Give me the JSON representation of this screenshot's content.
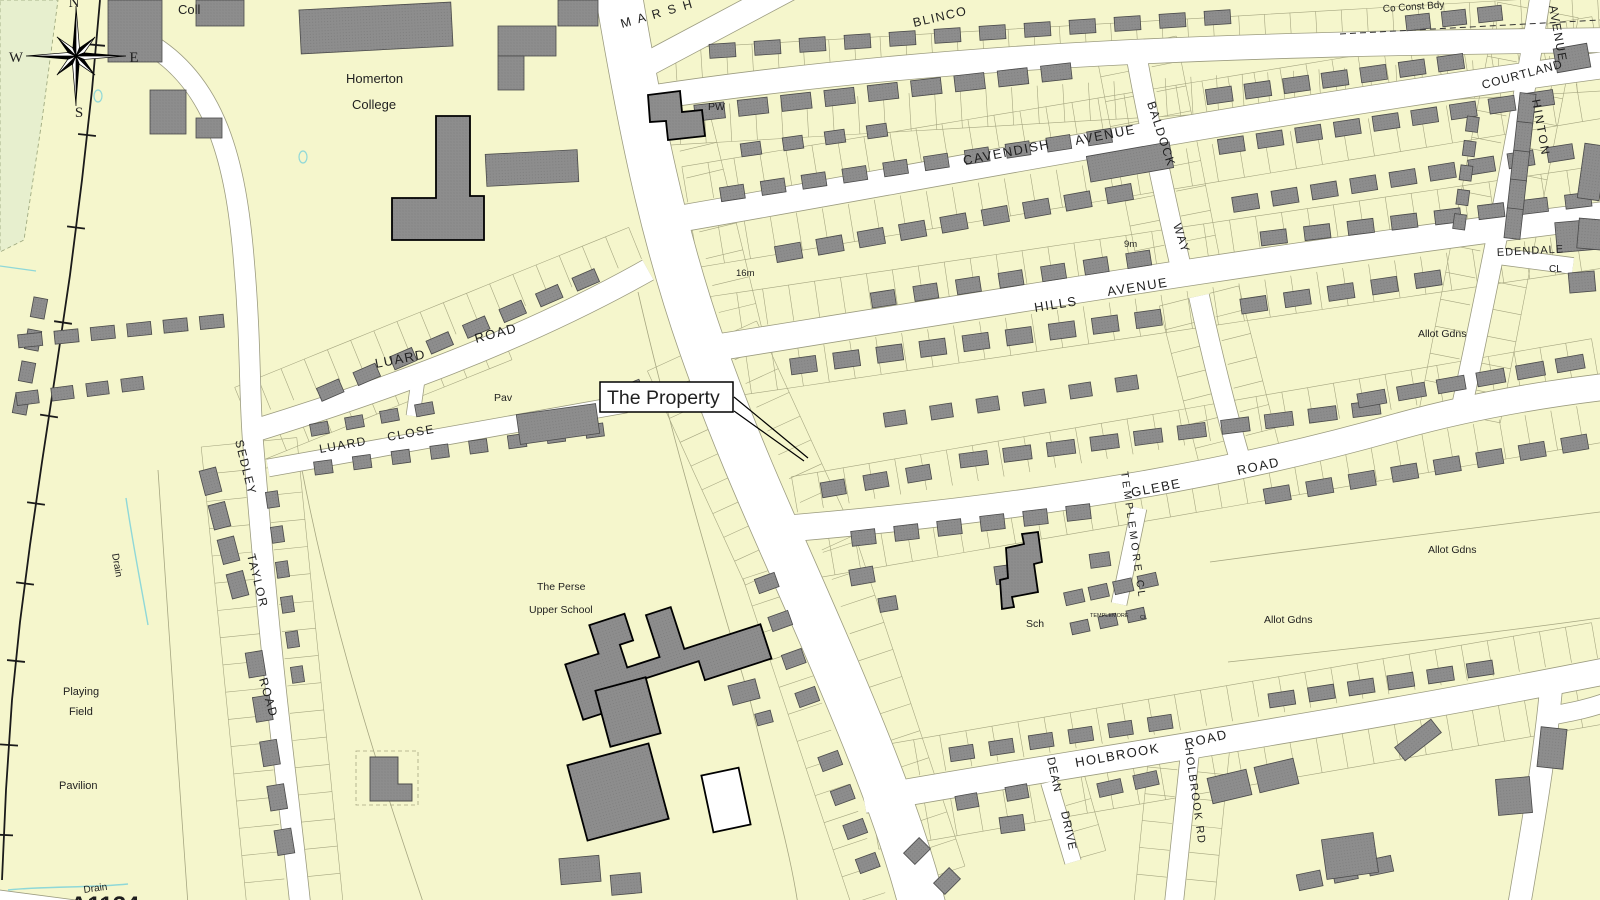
{
  "map": {
    "type": "street-map",
    "colors": {
      "background": "#f5f6cc",
      "road": "#ffffff",
      "road_edge": "#9c9c80",
      "building": "#8d8d8d",
      "building_dot": "#7b7b7b",
      "building_edge": "#4a4a4a",
      "bold_edge": "#000000",
      "parcel_line": "#a6a681",
      "railway": "#1a1a1a",
      "drain": "#8fd8d8",
      "green_area": "#e7efce",
      "label": "#1f1f1f",
      "callout_bg": "#ffffff",
      "callout_border": "#000000"
    },
    "callout": {
      "label": "The Property",
      "box": {
        "x": 600,
        "y": 382,
        "w": 133,
        "h": 30
      },
      "text_x": 607,
      "text_y": 404,
      "font_size": 19.5,
      "leader_lines": [
        [
          734,
          397,
          808,
          458
        ],
        [
          734,
          411,
          804,
          461
        ]
      ]
    },
    "labels": [
      {
        "i": "coll",
        "t": "Coll",
        "x": 178,
        "y": 14,
        "s": 13
      },
      {
        "i": "homerton-1",
        "t": "Homerton",
        "x": 346,
        "y": 83,
        "s": 13
      },
      {
        "i": "homerton-2",
        "t": "College",
        "x": 352,
        "y": 109,
        "s": 13
      },
      {
        "i": "marshall-road",
        "t": "M A R S H",
        "x": 622,
        "y": 28,
        "r": -16,
        "s": 12.5,
        "ls": 2
      },
      {
        "i": "blinco",
        "t": "BLINCO",
        "x": 914,
        "y": 27,
        "r": -13,
        "s": 12.5,
        "ls": 1.5
      },
      {
        "i": "pw",
        "t": "PW",
        "x": 708,
        "y": 110,
        "s": 10.5
      },
      {
        "i": "co-const-bdy",
        "t": "Co Const Bdy",
        "x": 1383,
        "y": 12,
        "r": -4,
        "s": 10
      },
      {
        "i": "avenue-hinton",
        "t": "AVENUE",
        "x": 1549,
        "y": 6,
        "r": 80,
        "s": 12,
        "ls": 1.5
      },
      {
        "i": "courtland",
        "t": "COURTLAND",
        "x": 1483,
        "y": 89,
        "r": -15,
        "s": 12,
        "ls": 1
      },
      {
        "i": "hinton",
        "t": "HINTON",
        "x": 1532,
        "y": 100,
        "r": 80,
        "s": 12,
        "ls": 2
      },
      {
        "i": "cavendish",
        "t": "CAVENDISH",
        "x": 964,
        "y": 165,
        "r": -11,
        "s": 13,
        "ls": 1.5
      },
      {
        "i": "avenue-cavendish",
        "t": "AVENUE",
        "x": 1076,
        "y": 145,
        "r": -11,
        "s": 13,
        "ls": 1.5
      },
      {
        "i": "baldock",
        "t": "BALDOCK",
        "x": 1147,
        "y": 103,
        "r": 72,
        "s": 12,
        "ls": 1.5
      },
      {
        "i": "way-baldock",
        "t": "WAY",
        "x": 1173,
        "y": 225,
        "r": 72,
        "s": 12,
        "ls": 1.5
      },
      {
        "i": "spot-height-9m",
        "t": "9m",
        "x": 1124,
        "y": 247,
        "s": 9.5
      },
      {
        "i": "spot-height-16m",
        "t": "16m",
        "x": 736,
        "y": 276,
        "s": 9.5
      },
      {
        "i": "edendale",
        "t": "EDENDALE",
        "x": 1497,
        "y": 256,
        "r": -3,
        "s": 11,
        "ls": 1
      },
      {
        "i": "edendale-cl",
        "t": "CL",
        "x": 1549,
        "y": 272,
        "s": 10
      },
      {
        "i": "hills-avenue-1",
        "t": "HILLS",
        "x": 1035,
        "y": 312,
        "r": -9,
        "s": 13,
        "ls": 1.5
      },
      {
        "i": "hills-avenue-2",
        "t": "AVENUE",
        "x": 1108,
        "y": 296,
        "r": -9,
        "s": 13,
        "ls": 1.5
      },
      {
        "i": "allot-gdns-1",
        "t": "Allot Gdns",
        "x": 1418,
        "y": 337,
        "s": 10.5
      },
      {
        "i": "allot-gdns-2",
        "t": "Allot Gdns",
        "x": 1428,
        "y": 553,
        "s": 10.5
      },
      {
        "i": "allot-gdns-3",
        "t": "Allot Gdns",
        "x": 1264,
        "y": 623,
        "s": 10.5
      },
      {
        "i": "luard-road-1",
        "t": "LUARD",
        "x": 376,
        "y": 368,
        "r": -11,
        "s": 13,
        "ls": 1.5
      },
      {
        "i": "luard-road-2",
        "t": "ROAD",
        "x": 476,
        "y": 343,
        "r": -15,
        "s": 13,
        "ls": 1.5
      },
      {
        "i": "pav",
        "t": "Pav",
        "x": 494,
        "y": 401,
        "s": 10.5
      },
      {
        "i": "luard-close-1",
        "t": "LUARD",
        "x": 320,
        "y": 453,
        "r": -10,
        "s": 12,
        "ls": 1.5
      },
      {
        "i": "luard-close-2",
        "t": "CLOSE",
        "x": 388,
        "y": 441,
        "r": -10,
        "s": 12,
        "ls": 1.5
      },
      {
        "i": "sedley",
        "t": "SEDLEY",
        "x": 235,
        "y": 441,
        "r": 76,
        "s": 12,
        "ls": 1.5
      },
      {
        "i": "taylor",
        "t": "TAYLOR",
        "x": 247,
        "y": 555,
        "r": 76,
        "s": 12,
        "ls": 1.5
      },
      {
        "i": "road-sedley",
        "t": "ROAD",
        "x": 259,
        "y": 679,
        "r": 74,
        "s": 12,
        "ls": 1.5
      },
      {
        "i": "drain-1",
        "t": "Drain",
        "x": 112,
        "y": 554,
        "r": 80,
        "s": 10
      },
      {
        "i": "perse-1",
        "t": "The Perse",
        "x": 537,
        "y": 590,
        "s": 10.5
      },
      {
        "i": "perse-2",
        "t": "Upper School",
        "x": 529,
        "y": 613,
        "s": 10.5
      },
      {
        "i": "glebe",
        "t": "GLEBE",
        "x": 1132,
        "y": 497,
        "r": -11,
        "s": 13,
        "ls": 1.5
      },
      {
        "i": "road-glebe",
        "t": "ROAD",
        "x": 1238,
        "y": 475,
        "r": -12,
        "s": 13,
        "ls": 1.5
      },
      {
        "i": "templemore-cl",
        "t": "TEMPLEMORE CL",
        "x": 1121,
        "y": 472,
        "r": 82,
        "s": 10.5,
        "ls": 3
      },
      {
        "i": "sch",
        "t": "Sch",
        "x": 1026,
        "y": 627,
        "s": 10.5
      },
      {
        "i": "templemore-small",
        "t": "TEMPLEMORE",
        "x": 1090,
        "y": 617,
        "s": 5.5
      },
      {
        "i": "templemore-small-cl",
        "t": "CL",
        "x": 1140,
        "y": 619,
        "s": 5.5
      },
      {
        "i": "playing",
        "t": "Playing",
        "x": 63,
        "y": 695,
        "s": 11
      },
      {
        "i": "field",
        "t": "Field",
        "x": 69,
        "y": 715,
        "s": 11
      },
      {
        "i": "pavilion",
        "t": "Pavilion",
        "x": 59,
        "y": 789,
        "s": 11
      },
      {
        "i": "drain-2",
        "t": "Drain",
        "x": 84,
        "y": 893,
        "r": -8,
        "s": 10
      },
      {
        "i": "a1134",
        "t": "A1134",
        "x": 70,
        "y": 913,
        "s": 24,
        "w": "bold"
      },
      {
        "i": "holbrook",
        "t": "HOLBROOK",
        "x": 1076,
        "y": 767,
        "r": -10,
        "s": 13,
        "ls": 1.5
      },
      {
        "i": "road-holbrook",
        "t": "ROAD",
        "x": 1186,
        "y": 748,
        "r": -13,
        "s": 13,
        "ls": 1.5
      },
      {
        "i": "dean",
        "t": "DEAN",
        "x": 1047,
        "y": 758,
        "r": 78,
        "s": 11.5,
        "ls": 1
      },
      {
        "i": "drive",
        "t": "DRIVE",
        "x": 1061,
        "y": 812,
        "r": 78,
        "s": 11.5,
        "ls": 1
      },
      {
        "i": "holbrook-rd-vertical",
        "t": "HOLBROOK RD",
        "x": 1185,
        "y": 748,
        "r": 82,
        "s": 11,
        "ls": 1.5
      },
      {
        "i": "compass-n",
        "t": "N",
        "x": 74,
        "y": 7,
        "s": 15,
        "a": "middle",
        "f": "serif"
      },
      {
        "i": "compass-e",
        "t": "E",
        "x": 134,
        "y": 62,
        "s": 15,
        "a": "middle",
        "f": "serif"
      },
      {
        "i": "compass-s",
        "t": "S",
        "x": 79,
        "y": 117,
        "s": 15,
        "a": "middle",
        "f": "serif"
      },
      {
        "i": "compass-w",
        "t": "W",
        "x": 16,
        "y": 62,
        "s": 15,
        "a": "middle",
        "f": "serif"
      }
    ]
  }
}
